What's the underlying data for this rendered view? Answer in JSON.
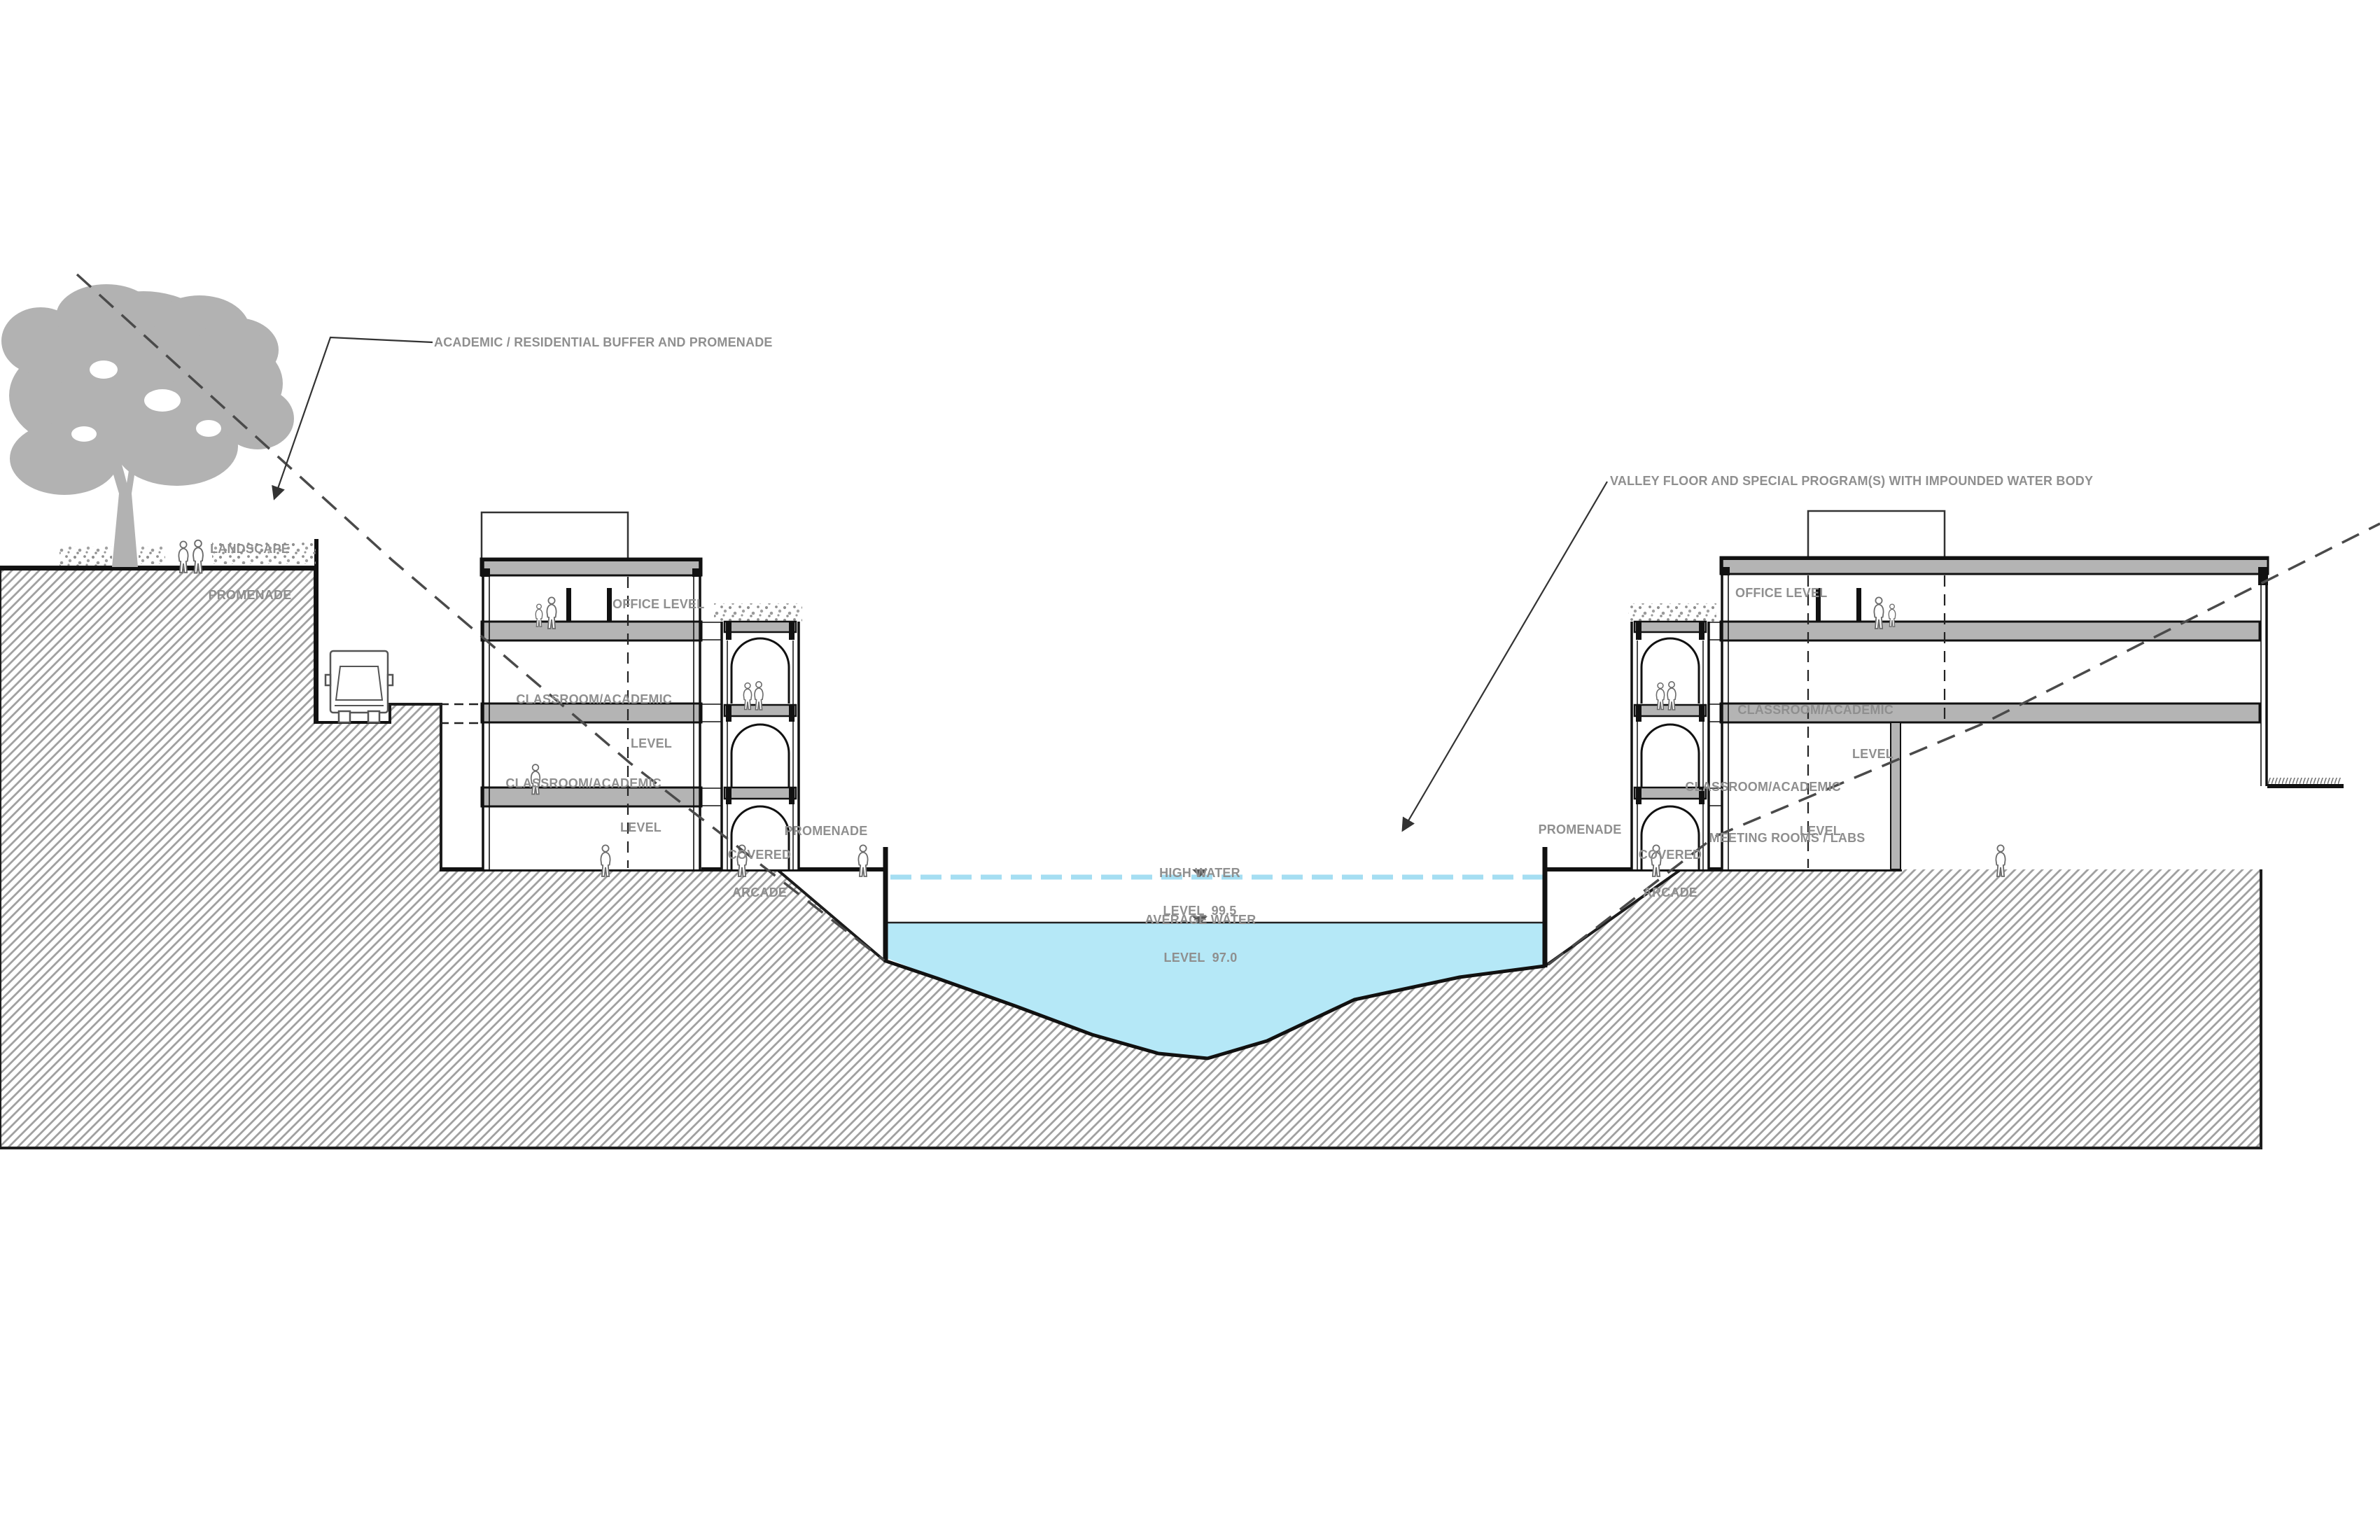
{
  "drawing": {
    "title_context": "site section through valley with academic buildings and impounded water body",
    "annotations": {
      "buffer": "ACADEMIC / RESIDENTIAL BUFFER AND PROMENADE",
      "valley": "VALLEY FLOOR AND SPECIAL PROGRAM(S) WITH IMPOUNDED WATER BODY",
      "landscape_line1": "LANDSCAPE",
      "landscape_line2": "PROMENADE"
    },
    "left_building": {
      "office": "OFFICE LEVEL",
      "classroom_upper_line1": "CLASSROOM/ACADEMIC",
      "classroom_upper_line2": "LEVEL",
      "classroom_lower_line1": "CLASSROOM/ACADEMIC",
      "classroom_lower_line2": "LEVEL",
      "arcade_line1": "COVERED",
      "arcade_line2": "ARCADE",
      "promenade": "PROMENADE"
    },
    "right_building": {
      "office": "OFFICE LEVEL",
      "classroom_upper_line1": "CLASSROOM/ACADEMIC",
      "classroom_upper_line2": "LEVEL",
      "classroom_lower_line1": "CLASSROOM/ACADEMIC",
      "classroom_lower_line2": "LEVEL",
      "meeting": "MEETING ROOMS / LABS",
      "arcade_line1": "COVERED",
      "arcade_line2": "ARCADE",
      "promenade": "PROMENADE"
    },
    "water": {
      "high_line1": "HIGH WATER",
      "high_line2": "LEVEL  99.5",
      "avg_line1": "AVERAGE WATER",
      "avg_line2": "LEVEL  97.0",
      "high_level": 99.5,
      "average_level": 97.0
    },
    "colors": {
      "water_fill": "#b5e8f7",
      "water_dash_line": "#a5def2",
      "slab_gray": "#b4b4b4",
      "tree_gray": "#b2b2b2",
      "hatch_line": "#a0a0a0",
      "label_text": "#8f8f8f",
      "drawing_line": "#1a1a1a"
    }
  }
}
